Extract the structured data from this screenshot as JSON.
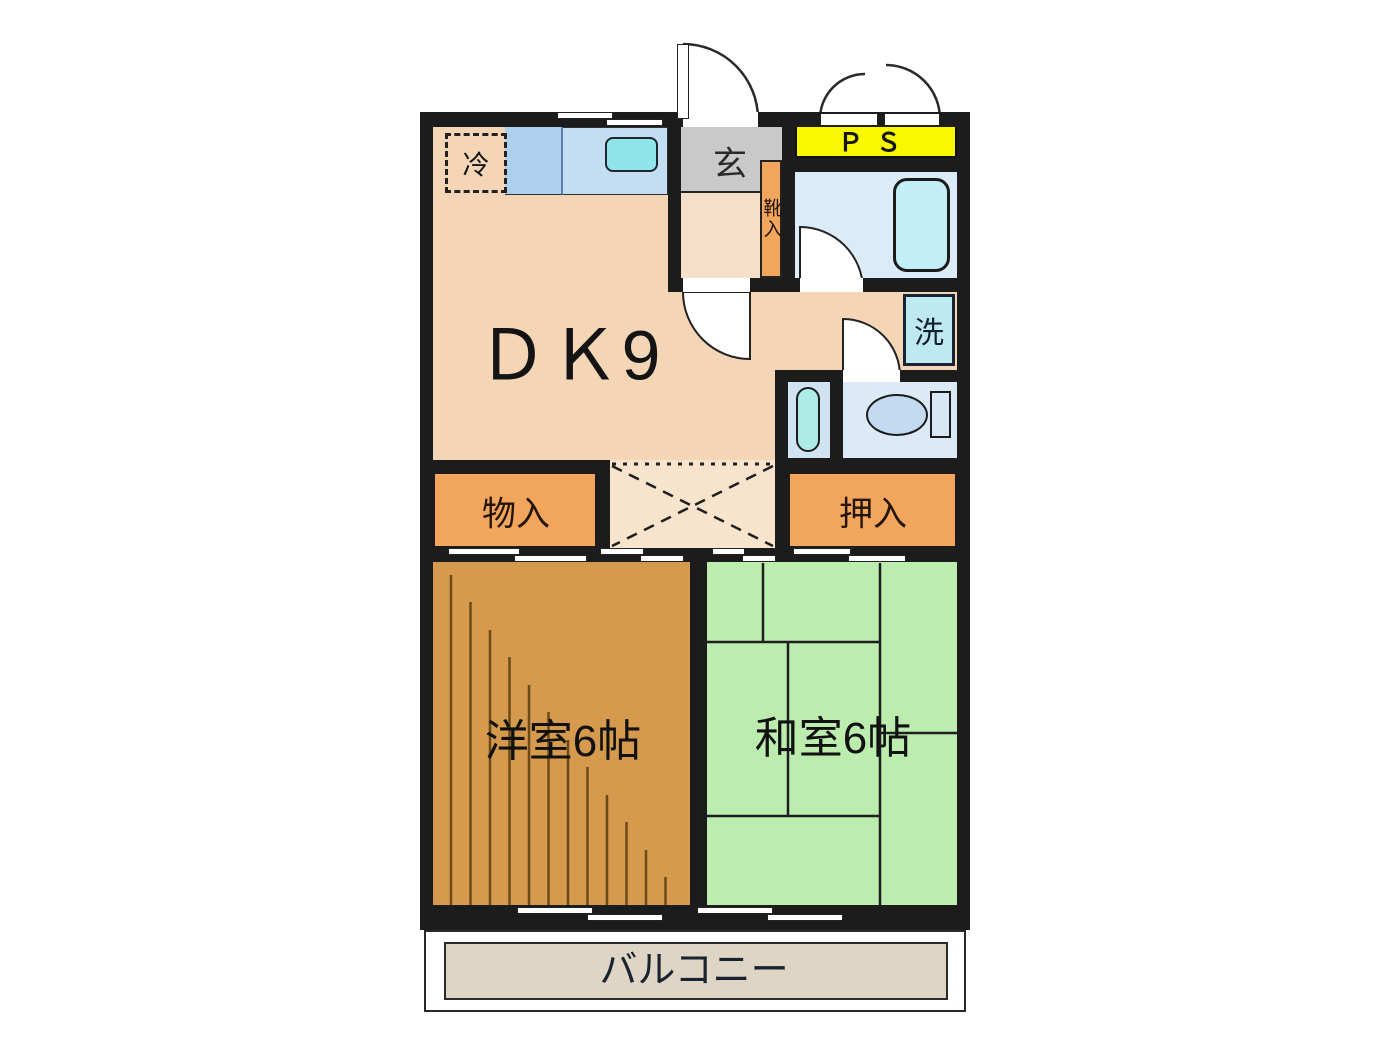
{
  "plan": {
    "dk_label": "ＤＫ9",
    "genkan_label": "玄",
    "shoe_label": "靴入",
    "ps_label": "ＰＳ",
    "fridge_label": "冷",
    "laundry_label": "洗",
    "storage_label": "物入",
    "closet_label": "押入",
    "western_label": "洋室6帖",
    "japanese_label": "和室6帖",
    "balcony_label": "バルコニー"
  },
  "colors": {
    "wall": "#1c1c1c",
    "floor-peach": "#f4d6b6",
    "hall-peach": "#f8e4cc",
    "genkan-gray": "#c9c9c9",
    "genkan-floor": "#f6dfc8",
    "closet-orange": "#f2a55c",
    "ps-yellow": "#f8f800",
    "counter-blue": "#c3ddf2",
    "counter-blue-dark": "#aed0ec",
    "sink-cyan": "#8fe5ea",
    "bath-blue": "#dcebf8",
    "tub-cyan": "#c2eff5",
    "laundry-blue": "#bfe9f2",
    "basin-room-blue": "#cfe3f3",
    "capsule-cyan": "#aeebe6",
    "toilet-blue": "#dceaf8",
    "fixture-blue": "#c4daf0",
    "wood": "#d59a4d",
    "wood-line": "#6b4a16",
    "tatami-green": "#bdedae",
    "balcony-beige": "#ded5c5",
    "line-dark": "#1e1e1e"
  }
}
